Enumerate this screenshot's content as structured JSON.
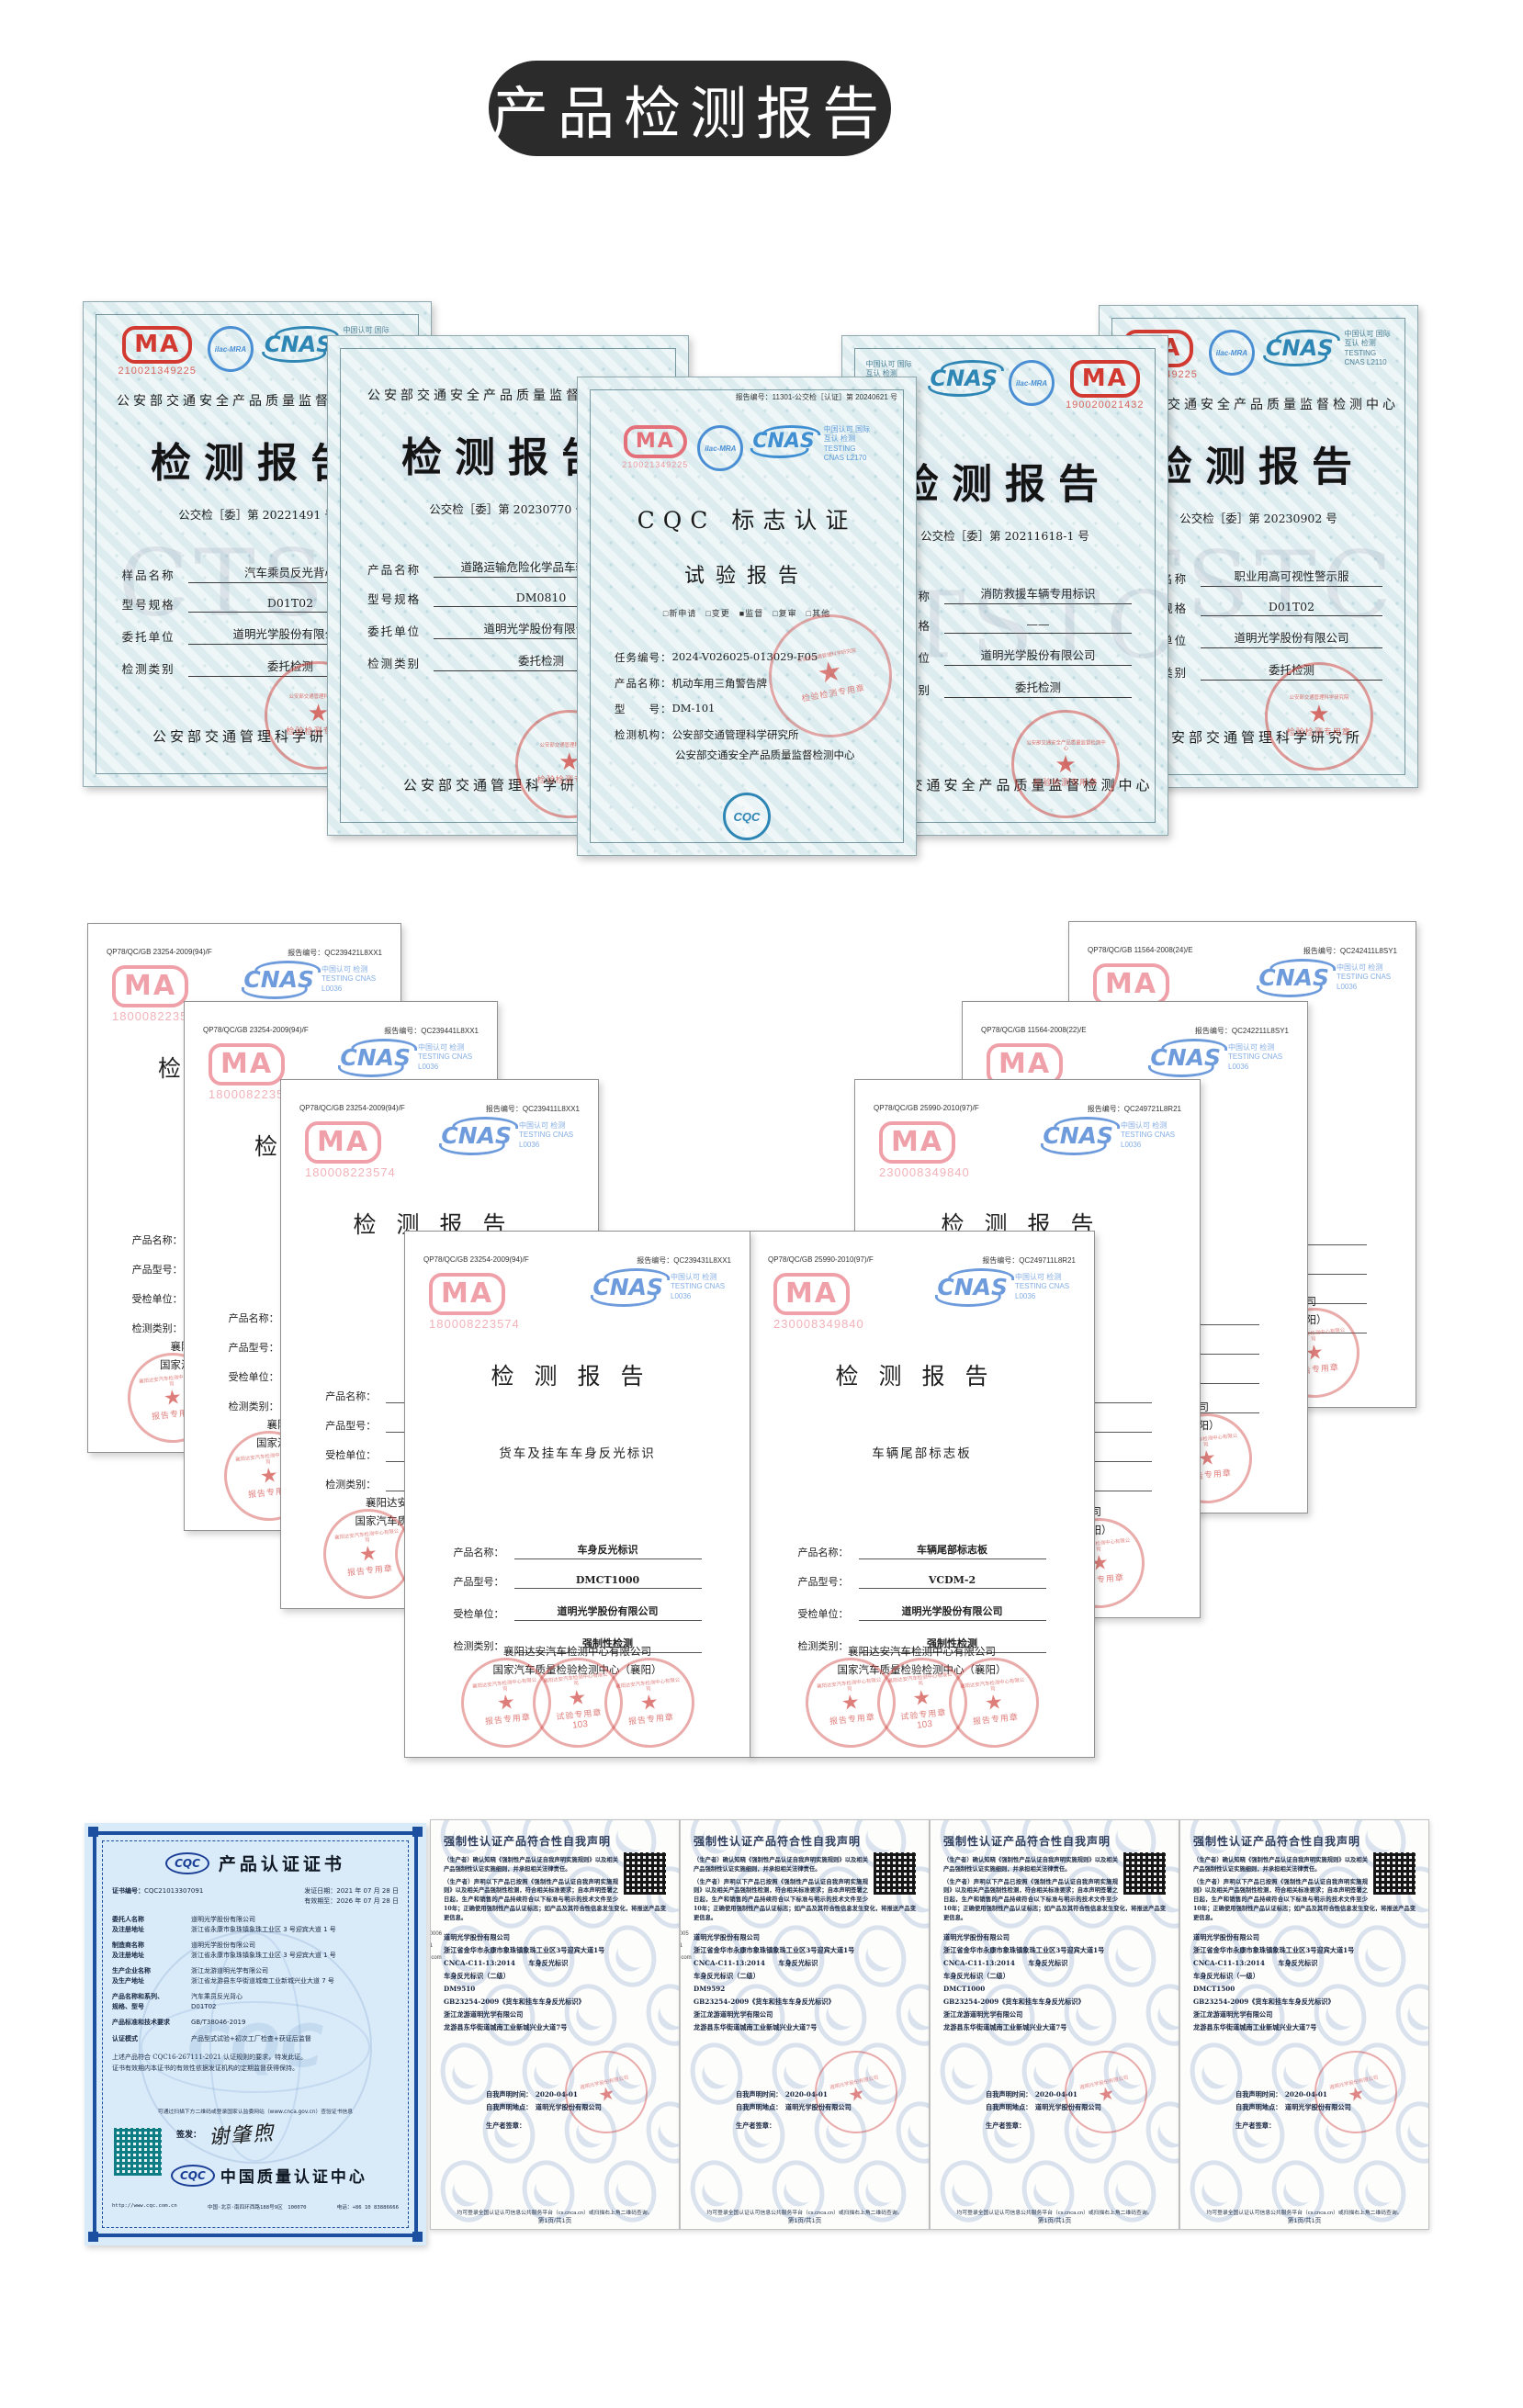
{
  "page": {
    "title": "产品检测报告"
  },
  "colors": {
    "banner": "#2b2b2b",
    "cma_red": "#d23a31",
    "cma_pink": "#ef9ba1",
    "cnas_blue": "#4a8fd4",
    "stamp_red": "#c9403a",
    "cqc_blue": "#1d4fa0"
  },
  "row1": {
    "certs": [
      {
        "org_top": "公安部交通安全产品质量监督检测中心",
        "cma_number": "210021349225",
        "ilac": "ilac-MRA",
        "cnas": "CNAS",
        "cnas_side": "中国认可 国际互认 检测 TESTING CNAS L2110",
        "title": "检测报告",
        "report_no": "公交检［委］第 20221491 号",
        "fields": [
          {
            "label": "样品名称",
            "value": "汽车乘员反光背心"
          },
          {
            "label": "型号规格",
            "value": "D01T02"
          },
          {
            "label": "委托单位",
            "value": "道明光学股份有限公司"
          },
          {
            "label": "检测类别",
            "value": "委托检测"
          }
        ],
        "footer": "公安部交通管理科学研究所",
        "stamp_ring": "公安部交通管理科学研究院",
        "stamp": "检验检测专用章",
        "watermark": "CTST"
      },
      {
        "org_top": "公安部交通安全产品质量监督检测中心",
        "cma_number": "",
        "ilac": "",
        "cnas": "",
        "cnas_side": "",
        "title": "检测报告",
        "report_no": "公交检［委］第 20230770 号",
        "fields": [
          {
            "label": "产品名称",
            "value": "道路运输危险化学品车辆警示牌"
          },
          {
            "label": "型号规格",
            "value": "DM0810"
          },
          {
            "label": "委托单位",
            "value": "道明光学股份有限公司"
          },
          {
            "label": "检测类别",
            "value": "委托检测"
          }
        ],
        "footer": "公安部交通管理科学研究所",
        "stamp_ring": "公安部交通管理科学研究院",
        "stamp": "检验检测专用章",
        "watermark": ""
      },
      {
        "org_top": "",
        "cma_number": "190020021432",
        "ilac": "ilac-MRA",
        "cnas": "CNAS",
        "cnas_side": "中国认可 国际互认 检测 TESTING CNAS L2110",
        "title": "检测报告",
        "report_no": "公交检［委］第 20211618-1 号",
        "fields": [
          {
            "label": "产品名称",
            "value": "消防救援车辆专用标识"
          },
          {
            "label": "型号规格",
            "value": "——"
          },
          {
            "label": "委托单位",
            "value": "道明光学股份有限公司"
          },
          {
            "label": "检测类别",
            "value": "委托检测"
          }
        ],
        "footer": "公安部交通安全产品质量监督检测中心",
        "stamp_ring": "公安部交通安全产品质量监督检测中心",
        "stamp": "检验检测专用章",
        "watermark": "CTSTC"
      },
      {
        "org_top": "公安部交通安全产品质量监督检测中心",
        "cma_number": "210021349225",
        "ilac": "ilac-MRA",
        "cnas": "CNAS",
        "cnas_side": "中国认可 国际互认 检测 TESTING CNAS L2110",
        "title": "检测报告",
        "report_no": "公交检［委］第 20230902 号",
        "fields": [
          {
            "label": "样品名称",
            "value": "职业用高可视性警示服"
          },
          {
            "label": "型号规格",
            "value": "D01T02"
          },
          {
            "label": "委托单位",
            "value": "道明光学股份有限公司"
          },
          {
            "label": "检测类别",
            "value": "委托检测"
          }
        ],
        "footer": "公安部交通管理科学研究所",
        "stamp_ring": "公安部交通管理科学研究院",
        "stamp": "检验检测专用章",
        "watermark": "TSTC"
      }
    ],
    "center": {
      "report_no": "报告编号：11301-公交检［认证］第 20240621 号",
      "cma_number": "210021349225",
      "ilac": "ilac-MRA",
      "cnas": "CNAS",
      "cnas_side": "中国认可 国际互认 检测 TESTING CNAS L2170",
      "title1": "CQC 标志认证",
      "title2": "试验报告",
      "checks": "□新申请　□变更　■监督　□复审　□其他",
      "rows": [
        {
          "label": "任务编号：",
          "value": "2024-V026025-013029-F05"
        },
        {
          "label": "产品名称：",
          "value": "机动车用三角警告牌"
        },
        {
          "label": "型　　号：",
          "value": "DM-101"
        },
        {
          "label": "检测机构：",
          "value": "公安部交通管理科学研究所"
        },
        {
          "label": "",
          "value": "公安部交通安全产品质量监督检测中心"
        }
      ],
      "stamp_ring": "公安部交通管理科学研究院",
      "stamp": "检验检测专用章",
      "cqc": "CQC"
    }
  },
  "group2": {
    "certs": [
      {
        "code": "QP78/QC/GB 23254-2009(94)/F",
        "report_no": "报告编号：QC239421L8XX1",
        "cma_number": "180008223574",
        "cnas": "CNAS",
        "cnas_side": "中国认可 检测 TESTING CNAS L0036",
        "title": "检测报告",
        "subtitle": "",
        "fields": [
          {
            "label": "产品名称：",
            "value": ""
          },
          {
            "label": "产品型号：",
            "value": ""
          },
          {
            "label": "受检单位：",
            "value": ""
          },
          {
            "label": "检测类别：",
            "value": ""
          }
        ],
        "org1": "襄阳达安汽车检测中心有限公司",
        "org2": "国家汽车质量检验检测中心（襄阳）",
        "stamp_ring": "襄阳达安汽车检测中心有限公司",
        "stamp_left": "报告专用章",
        "stamp_mid": "试验专用章",
        "stamp_mid_num": "103",
        "stamp_right": "报告专用章"
      },
      {
        "code": "QP78/QC/GB 23254-2009(94)/F",
        "report_no": "报告编号：QC239441L8XX1",
        "cma_number": "180008223574",
        "cnas": "CNAS",
        "cnas_side": "中国认可 检测 TESTING CNAS L0036",
        "title": "检测报告",
        "subtitle": "",
        "fields": [
          {
            "label": "产品名称：",
            "value": ""
          },
          {
            "label": "产品型号：",
            "value": ""
          },
          {
            "label": "受检单位：",
            "value": ""
          },
          {
            "label": "检测类别：",
            "value": ""
          }
        ],
        "org1": "襄阳达安汽车检测中心有限公司",
        "org2": "国家汽车质量检验检测中心（襄阳）",
        "stamp_ring": "襄阳达安汽车检测中心有限公司",
        "stamp_left": "报告专用章",
        "stamp_mid": "试验专用章",
        "stamp_mid_num": "103",
        "stamp_right": "报告专用章"
      },
      {
        "code": "QP78/QC/GB 23254-2009(94)/F",
        "report_no": "报告编号：QC239411L8XX1",
        "cma_number": "180008223574",
        "cnas": "CNAS",
        "cnas_side": "中国认可 检测 TESTING CNAS L0036",
        "title": "检测报告",
        "subtitle": "",
        "fields": [
          {
            "label": "产品名称：",
            "value": ""
          },
          {
            "label": "产品型号：",
            "value": ""
          },
          {
            "label": "受检单位：",
            "value": ""
          },
          {
            "label": "检测类别：",
            "value": ""
          }
        ],
        "org1": "襄阳达安汽车检测中心有限公司",
        "org2": "国家汽车质量检验检测中心（襄阳）",
        "stamp_ring": "襄阳达安汽车检测中心有限公司",
        "stamp_left": "报告专用章",
        "stamp_mid": "试验专用章",
        "stamp_mid_num": "103",
        "stamp_right": "报告专用章"
      },
      {
        "code": "QP78/QC/GB 23254-2009(94)/F",
        "report_no": "报告编号：QC239431L8XX1",
        "cma_number": "180008223574",
        "cnas": "CNAS",
        "cnas_side": "中国认可 检测 TESTING CNAS L0036",
        "title": "检测报告",
        "subtitle": "货车及挂车车身反光标识",
        "fields": [
          {
            "label": "产品名称：",
            "value": "车身反光标识"
          },
          {
            "label": "产品型号：",
            "value": "DMCT1000"
          },
          {
            "label": "受检单位：",
            "value": "道明光学股份有限公司"
          },
          {
            "label": "检测类别：",
            "value": "强制性检测"
          }
        ],
        "org1": "襄阳达安汽车检测中心有限公司",
        "org2": "国家汽车质量检验检测中心（襄阳）",
        "stamp_ring": "襄阳达安汽车检测中心有限公司",
        "stamp_left": "报告专用章",
        "stamp_mid": "试验专用章",
        "stamp_mid_num": "103",
        "stamp_right": "报告专用章"
      },
      {
        "code": "QP78/QC/GB 11564-2008(24)/E",
        "report_no": "报告编号：QC242411L8SY1",
        "cma_number": "230008349840",
        "cnas": "CNAS",
        "cnas_side": "中国认可 检测 TESTING CNAS L0036",
        "title": "检测报告",
        "subtitle": "",
        "fields": [
          {
            "label": "产品名称：",
            "value": ""
          },
          {
            "label": "产品型号：",
            "value": ""
          },
          {
            "label": "受检单位：",
            "value": ""
          },
          {
            "label": "检测类别：",
            "value": ""
          }
        ],
        "org1": "襄阳达安汽车检测中心有限公司",
        "org2": "国家汽车质量检验检测中心（襄阳）",
        "stamp_ring": "襄阳达安汽车检测中心有限公司",
        "stamp_left": "报告专用章",
        "stamp_mid": "试验专用章",
        "stamp_mid_num": "103",
        "stamp_right": "报告专用章"
      },
      {
        "code": "QP78/QC/GB 11564-2008(22)/E",
        "report_no": "报告编号：QC242211L8SY1",
        "cma_number": "230008349840",
        "cnas": "CNAS",
        "cnas_side": "中国认可 检测 TESTING CNAS L0036",
        "title": "检测报告",
        "subtitle": "",
        "fields": [
          {
            "label": "产品名称：",
            "value": ""
          },
          {
            "label": "产品型号：",
            "value": ""
          },
          {
            "label": "受检单位：",
            "value": ""
          },
          {
            "label": "检测类别：",
            "value": ""
          }
        ],
        "org1": "襄阳达安汽车检测中心有限公司",
        "org2": "国家汽车质量检验检测中心（襄阳）",
        "stamp_ring": "襄阳达安汽车检测中心有限公司",
        "stamp_left": "报告专用章",
        "stamp_mid": "试验专用章",
        "stamp_mid_num": "103",
        "stamp_right": "报告专用章"
      },
      {
        "code": "QP78/QC/GB 25990-2010(97)/F",
        "report_no": "报告编号：QC249721L8R21",
        "cma_number": "230008349840",
        "cnas": "CNAS",
        "cnas_side": "中国认可 检测 TESTING CNAS L0036",
        "title": "检测报告",
        "subtitle": "",
        "fields": [
          {
            "label": "产品名称：",
            "value": ""
          },
          {
            "label": "产品型号：",
            "value": ""
          },
          {
            "label": "受检单位：",
            "value": ""
          },
          {
            "label": "检测类别：",
            "value": ""
          }
        ],
        "org1": "襄阳达安汽车检测中心有限公司",
        "org2": "国家汽车质量检验检测中心（襄阳）",
        "stamp_ring": "襄阳达安汽车检测中心有限公司",
        "stamp_left": "报告专用章",
        "stamp_mid": "试验专用章",
        "stamp_mid_num": "103",
        "stamp_right": "报告专用章"
      },
      {
        "code": "QP78/QC/GB 25990-2010(97)/F",
        "report_no": "报告编号：QC249711L8R21",
        "cma_number": "230008349840",
        "cnas": "CNAS",
        "cnas_side": "中国认可 检测 TESTING CNAS L0036",
        "title": "检测报告",
        "subtitle": "车辆尾部标志板",
        "fields": [
          {
            "label": "产品名称：",
            "value": "车辆尾部标志板"
          },
          {
            "label": "产品型号：",
            "value": "VCDM-2"
          },
          {
            "label": "受检单位：",
            "value": "道明光学股份有限公司"
          },
          {
            "label": "检测类别：",
            "value": "强制性检测"
          }
        ],
        "org1": "襄阳达安汽车检测中心有限公司",
        "org2": "国家汽车质量检验检测中心（襄阳）",
        "stamp_ring": "襄阳达安汽车检测中心有限公司",
        "stamp_left": "报告专用章",
        "stamp_mid": "试验专用章",
        "stamp_mid_num": "103",
        "stamp_right": "报告专用章"
      }
    ]
  },
  "bottom": {
    "cqc_cert": {
      "logo": "CQC",
      "title": "产品认证证书",
      "no_label": "证书编号：",
      "no": "CQC21013307091",
      "issue": "发证日期：2021 年 07 月 28 日",
      "valid": "有效期至：2026 年 07 月 28 日",
      "rows": [
        {
          "label": "委托人名称",
          "label2": "及注册地址",
          "v1": "道明光学股份有限公司",
          "v2": "浙江省永康市象珠镇象珠工业区 3 号迎宾大道 1 号"
        },
        {
          "label": "制造商名称",
          "label2": "及注册地址",
          "v1": "道明光学股份有限公司",
          "v2": "浙江省永康市象珠镇象珠工业区 3 号迎宾大道 1 号"
        },
        {
          "label": "生产企业名称",
          "label2": "及生产地址",
          "v1": "浙江龙游道明光学有限公司",
          "v2": "浙江省龙游县东华街道城南工业新城兴业大道 7 号"
        },
        {
          "label": "产品名称和系列、",
          "label2": "规格、型号",
          "v1": "汽车乘员反光背心",
          "v2": "D01T02"
        },
        {
          "label": "产品标准和技术要求",
          "label2": "",
          "v1": "GB/T38046-2019",
          "v2": ""
        },
        {
          "label": "认证模式",
          "label2": "",
          "v1": "产品型式试验+初次工厂检查+获证后监督",
          "v2": ""
        }
      ],
      "para1": "上述产品符合 CQC16-267111-2021 认证规则的要求，特发此证。",
      "para2": "证书有效期内本证书的有效性依据发证机构的定期监督获得保持。",
      "qr_note": "可通过扫描下方二维码或登录国家认监委网站（www.cnca.gov.cn）查验证书信息",
      "sign_label": "签发：",
      "signer": "谢肇煦",
      "org_logo": "CQC",
      "org": "中国质量认证中心",
      "footer_url": "http://www.cqc.com.cn",
      "footer_addr": "中国·北京·南四环西路188号9区　100070",
      "footer_tel": "电话：+86 10 83886666",
      "watermark": "CQC"
    },
    "declarations": [
      {
        "title": "强制性认证产品符合性自我声明",
        "para1": "（生产者）确认知晓《强制性产品认证自我声明实施规则》以及相关产品强制性认证实施细则，并承担相关法律责任。",
        "para2": "（生产者）声明以下产品已按照《强制性产品认证自我声明实施规则》以及相关产品强制性检测，符合相关标准要求；自本声明签署之日起，生产和销售的产品持续符合以下标准与明示的技术文件至少10年；正确使用强制性产品认证标志；如产品及其符合性信息发生变化，将报送产品变更信息。",
        "company": "道明光学股份有限公司",
        "address": "浙江省金华市永康市象珠镇象珠工业区3号迎宾大道1号",
        "cnca": "CNCA-C11-13:2014　　车身反光标识",
        "product": "车身反光标识（二级）",
        "model": "DM9510",
        "standard": "GB23254-2009《货车和挂车车身反光标识》",
        "factory": "浙江龙游道明光学有限公司",
        "factory_addr": "龙游县东华街道城南工业新城兴业大道7号",
        "time": "自我声明时间：　2020-04-01",
        "place": "自我声明地点：　道明光学股份有限公司",
        "sign": "生产者签章：",
        "stamp_ring": "道明光学股份有限公司",
        "footer": "均可登录全国认证认可信息公共服务平台（cx.cnca.cn）或扫描右上角二维码查询。",
        "page_no": "第1页/共1页",
        "frag1": "000006",
        "frag2": "871",
        "frag3": "63.com"
      },
      {
        "title": "强制性认证产品符合性自我声明",
        "para1": "（生产者）确认知晓《强制性产品认证自我声明实施规则》以及相关产品强制性认证实施细则，并承担相关法律责任。",
        "para2": "（生产者）声明以下产品已按照《强制性产品认证自我声明实施规则》以及相关产品强制性检测，符合相关标准要求；自本声明签署之日起，生产和销售的产品持续符合以下标准与明示的技术文件至少10年；正确使用强制性产品认证标志；如产品及其符合性信息发生变化，将报送产品变更信息。",
        "company": "道明光学股份有限公司",
        "address": "浙江省金华市永康市象珠镇象珠工业区3号迎宾大道1号",
        "cnca": "CNCA-C11-13:2014　　车身反光标识",
        "product": "车身反光标识（二级）",
        "model": "DM9592",
        "standard": "GB23254-2009《货车和挂车车身反光标识》",
        "factory": "浙江龙游道明光学有限公司",
        "factory_addr": "龙游县东华街道城南工业新城兴业大道7号",
        "time": "自我声明时间：　2020-04-01",
        "place": "自我声明地点：　道明光学股份有限公司",
        "sign": "生产者签章：",
        "stamp_ring": "道明光学股份有限公司",
        "footer": "均可登录全国认证认可信息公共服务平台（cx.cnca.cn）或扫描右上角二维码查询。",
        "page_no": "第1页/共1页",
        "frag1": "00005",
        "frag2": "871",
        "frag3": "63.com"
      },
      {
        "title": "强制性认证产品符合性自我声明",
        "para1": "（生产者）确认知晓《强制性产品认证自我声明实施规则》以及相关产品强制性认证实施细则，并承担相关法律责任。",
        "para2": "（生产者）声明以下产品已按照《强制性产品认证自我声明实施规则》以及相关产品强制性检测，符合相关标准要求；自本声明签署之日起，生产和销售的产品持续符合以下标准与明示的技术文件至少10年；正确使用强制性产品认证标志；如产品及其符合性信息发生变化，将报送产品变更信息。",
        "company": "道明光学股份有限公司",
        "address": "浙江省金华市永康市象珠镇象珠工业区3号迎宾大道1号",
        "cnca": "CNCA-C11-13:2014　　车身反光标识",
        "product": "车身反光标识（二级）",
        "model": "DMCT1000",
        "standard": "GB23254-2009《货车和挂车车身反光标识》",
        "factory": "浙江龙游道明光学有限公司",
        "factory_addr": "龙游县东华街道城南工业新城兴业大道7号",
        "time": "自我声明时间：　2020-04-01",
        "place": "自我声明地点：　道明光学股份有限公司",
        "sign": "生产者签章：",
        "stamp_ring": "道明光学股份有限公司",
        "footer": "均可登录全国认证认可信息公共服务平台（cx.cnca.cn）或扫描右上角二维码查询。",
        "page_no": "第1页/共1页",
        "frag1": "",
        "frag2": "",
        "frag3": ""
      },
      {
        "title": "强制性认证产品符合性自我声明",
        "para1": "（生产者）确认知晓《强制性产品认证自我声明实施规则》以及相关产品强制性认证实施细则，并承担相关法律责任。",
        "para2": "（生产者）声明以下产品已按照《强制性产品认证自我声明实施规则》以及相关产品强制性检测，符合相关标准要求；自本声明签署之日起，生产和销售的产品持续符合以下标准与明示的技术文件至少10年；正确使用强制性产品认证标志；如产品及其符合性信息发生变化，将报送产品变更信息。",
        "company": "道明光学股份有限公司",
        "address": "浙江省金华市永康市象珠镇象珠工业区3号迎宾大道1号",
        "cnca": "CNCA-C11-13:2014　　车身反光标识",
        "product": "车身反光标识（一级）",
        "model": "DMCT1500",
        "standard": "GB23254-2009《货车和挂车车身反光标识》",
        "factory": "浙江龙游道明光学有限公司",
        "factory_addr": "龙游县东华街道城南工业新城兴业大道7号",
        "time": "自我声明时间：　2020-04-01",
        "place": "自我声明地点：　道明光学股份有限公司",
        "sign": "生产者签章：",
        "stamp_ring": "道明光学股份有限公司",
        "footer": "均可登录全国认证认可信息公共服务平台（cx.cnca.cn）或扫描右上角二维码查询。",
        "page_no": "第1页/共1页",
        "frag1": "",
        "frag2": "",
        "frag3": ""
      }
    ]
  }
}
